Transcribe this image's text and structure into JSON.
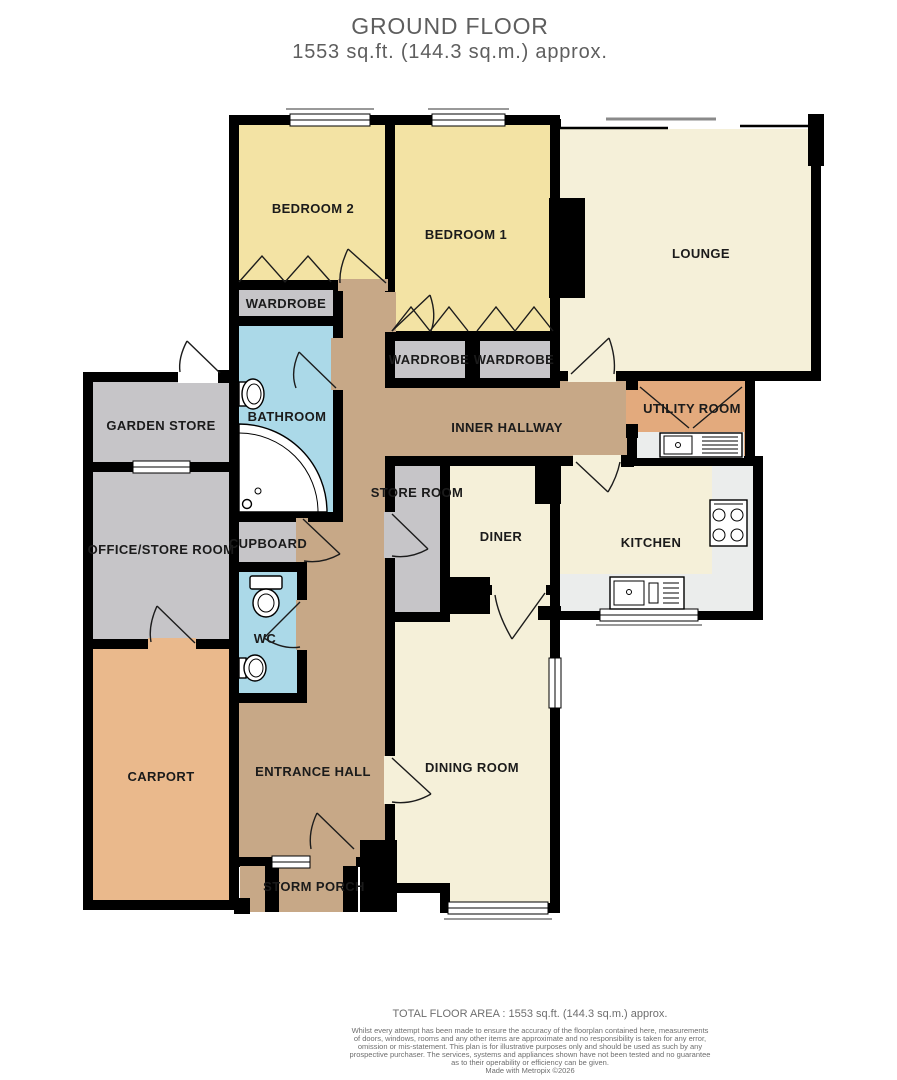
{
  "title": {
    "heading": "GROUND FLOOR",
    "subheading": "1553 sq.ft. (144.3 sq.m.) approx."
  },
  "rooms": {
    "bedroom2": "BEDROOM 2",
    "bedroom1": "BEDROOM 1",
    "lounge": "LOUNGE",
    "wardrobe_bedroom2": "WARDROBE",
    "wardrobe_left": "WARDROBE",
    "wardrobe_right": "WARDROBE",
    "bathroom": "BATHROOM",
    "inner_hallway": "INNER HALLWAY",
    "utility_room": "UTILITY ROOM",
    "garden_store": "GARDEN STORE",
    "office_store_room": "OFFICE/STORE ROOM",
    "cupboard": "CUPBOARD",
    "store_room": "STORE ROOM",
    "diner": "DINER",
    "kitchen": "KITCHEN",
    "wc": "WC",
    "carport": "CARPORT",
    "entrance_hall": "ENTRANCE HALL",
    "dining_room": "DINING ROOM",
    "storm_porch": "STORM PORCH"
  },
  "footer": {
    "total_area": "TOTAL FLOOR AREA : 1553 sq.ft. (144.3 sq.m.) approx.",
    "disclaimer_lines": [
      "Whilst every attempt has been made to ensure the accuracy of the floorplan contained here, measurements",
      "of doors, windows, rooms and any other items are approximate and no responsibility is taken for any error,",
      "omission or mis-statement. This plan is for illustrative purposes only and should be used as such by any",
      "prospective purchaser. The services, systems and appliances shown have not been tested and no guarantee",
      "as to their operability or efficiency can be given."
    ],
    "credit": "Made with Metropix ©2026"
  },
  "colors": {
    "wall": "#000000",
    "bedroom_yellow": "#F3E3A4",
    "cream": "#F5F0D9",
    "hall_tan": "#C7A887",
    "store_gray": "#C6C5C8",
    "wet_blue": "#ABD9E8",
    "carport_orange": "#EAB98C",
    "utility_orange": "#E3AA7D",
    "counter_gray": "#EBEDEC",
    "sill_gray": "#8A8A8A"
  }
}
